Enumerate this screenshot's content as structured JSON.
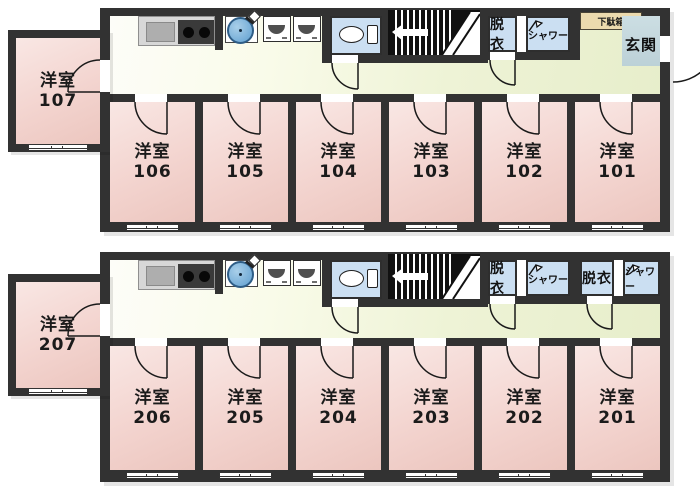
{
  "labels": {
    "room_type": "洋室",
    "dressing_room": "脱衣",
    "shower": "シャワー",
    "shoe_cabinet": "下駄箱",
    "entrance": "玄関"
  },
  "colors": {
    "wall": "#323232",
    "room_pink": "#f3d4cf",
    "corridor_green": "#edf2d4",
    "water_blue": "#cbdff2",
    "entrance_tile": "#c4d7dc",
    "shoe_cabinet_tan": "#ecdaae",
    "stairs_black": "#111111",
    "basin_blue": "#6fa9d6"
  },
  "floors": [
    {
      "annex": {
        "type": "洋室",
        "number": "107"
      },
      "rooms": [
        {
          "type": "洋室",
          "number": "106"
        },
        {
          "type": "洋室",
          "number": "105"
        },
        {
          "type": "洋室",
          "number": "104"
        },
        {
          "type": "洋室",
          "number": "103"
        },
        {
          "type": "洋室",
          "number": "102"
        },
        {
          "type": "洋室",
          "number": "101"
        }
      ]
    },
    {
      "annex": {
        "type": "洋室",
        "number": "207"
      },
      "rooms": [
        {
          "type": "洋室",
          "number": "206"
        },
        {
          "type": "洋室",
          "number": "205"
        },
        {
          "type": "洋室",
          "number": "204"
        },
        {
          "type": "洋室",
          "number": "203"
        },
        {
          "type": "洋室",
          "number": "202"
        },
        {
          "type": "洋室",
          "number": "201"
        }
      ]
    }
  ]
}
